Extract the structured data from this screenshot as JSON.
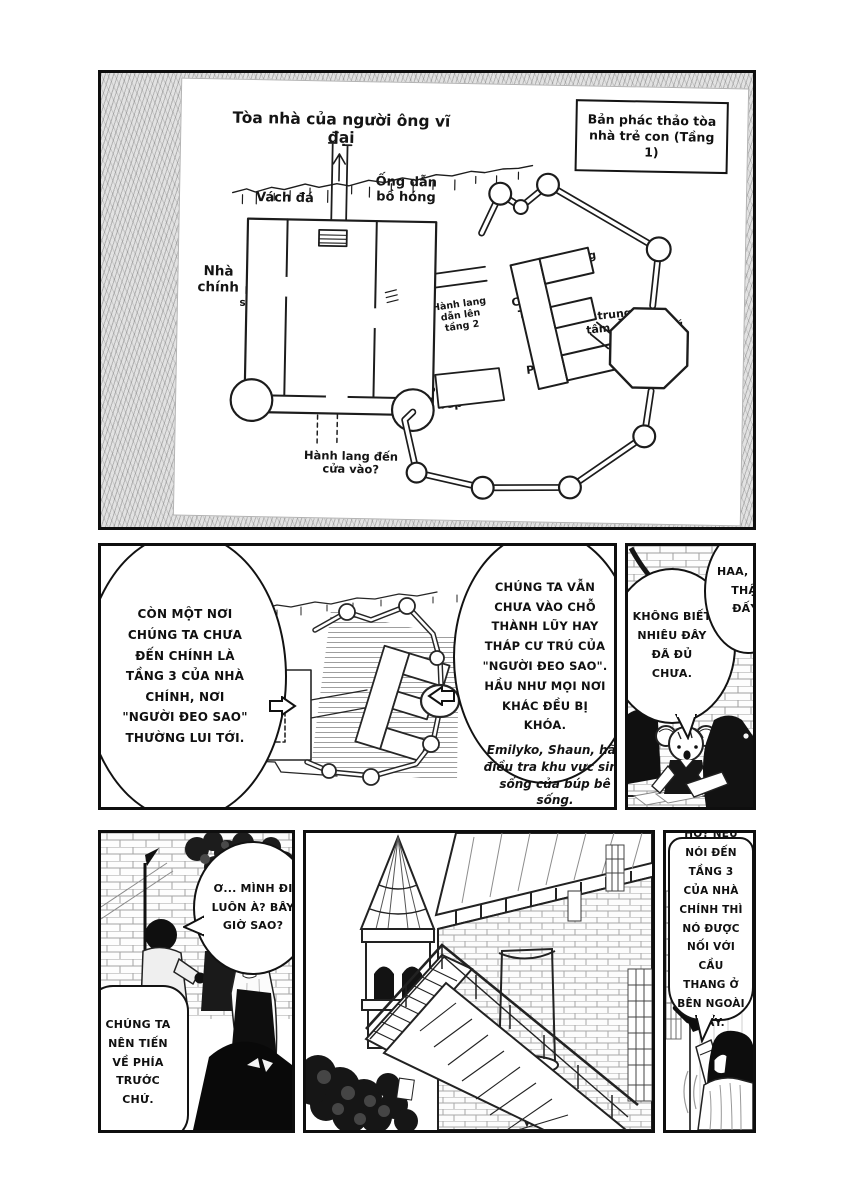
{
  "colors": {
    "ink": "#141414",
    "paper": "#ffffff"
  },
  "map_panel": {
    "title": "Tòa nhà của người ông vĩ đại",
    "legend": "Bản phác thảo tòa nhà trẻ con (Tầng 1)",
    "labels": {
      "cliff": "Vách đá",
      "soot_duct": "Ống dẫn bồ hóng",
      "main_house": "Nhà chính",
      "hobby_room_left": "Phòng sở thích",
      "great_hall": "Hội trường lớn",
      "hobby_room_right": "Phòng sở thích",
      "corridor_floor2": "Hành lang dẫn lên tầng 2",
      "kitchen": "Phòng bếp",
      "south_room": "Phòng Nam",
      "west_wing": "Cánh Tây",
      "central_garden": "Vườn trung tâm",
      "women_room": "Phòng Nữ",
      "star_bearer_tower": "Tháp cư trú của người đeo sao",
      "entrance_corridor": "Hành lang đến cửa vào?"
    }
  },
  "briefing_panel": {
    "bubble_left": "CÒN MỘT NƠI CHÚNG TA CHƯA ĐẾN CHÍNH LÀ TẦNG 3 CỦA NHÀ CHÍNH, NƠI \"NGƯỜI ĐEO SAO\" THƯỜNG LUI TỚI.",
    "bubble_right": "CHÚNG TA VẪN CHƯA VÀO CHỖ THÀNH LŨY HAY THÁP CƯ TRÚ CỦA \"NGƯỜI ĐEO SAO\". HẦU NHƯ MỌI NƠI KHÁC ĐỀU BỊ KHÓA.",
    "caption": "Emilyko, Shaun, hãy điều tra khu vực sinh sống của búp bê sống."
  },
  "table_panel": {
    "bubble_left": "KHÔNG BIẾT NHIÊU ĐÂY ĐÃ ĐỦ CHƯA.",
    "bubble_right": "HAA, MỆT THẬT ĐẤY!"
  },
  "walk_panel": {
    "bubble_top": "Ơ... MÌNH ĐI LUÔN À? BÂY GIỜ SAO?",
    "bubble_bottom": "CHÚNG TA NÊN TIẾN VỀ PHÍA TRƯỚC CHỨ."
  },
  "point_panel": {
    "bubble": "HỞ? NẾU NÓI ĐẾN TẦNG 3 CỦA NHÀ CHÍNH THÌ NÓ ĐƯỢC NỐI VỚI CẦU THANG Ở BÊN NGOÀI ĐẤY."
  }
}
